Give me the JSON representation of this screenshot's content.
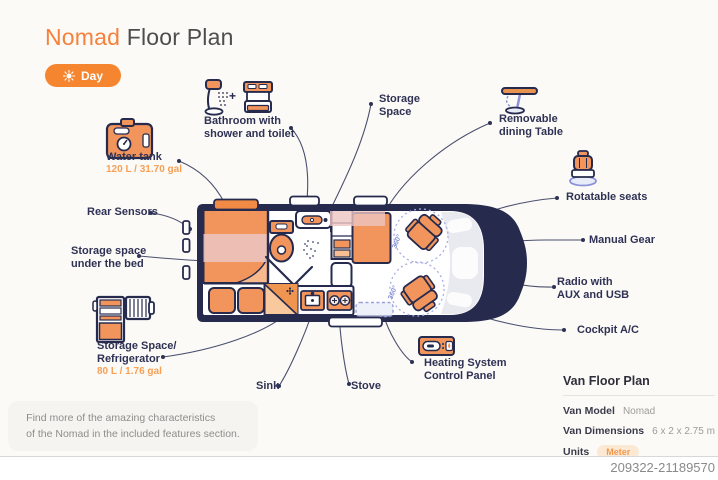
{
  "header": {
    "title_accent": "Nomad",
    "title_rest": " Floor Plan",
    "day_toggle": "Day"
  },
  "icons": {
    "bathroom_join": "+"
  },
  "labels": {
    "bathroom": "Bathroom with\nshower and toilet",
    "storage_space": "Storage\nSpace",
    "removable_table": "Removable\ndining Table",
    "water_tank": {
      "name": "Water tank",
      "value": "120 L / 31.70 gal"
    },
    "rear_sensors": "Rear Sensors",
    "storage_under_bed": "Storage space\nunder the bed",
    "refrigerator": {
      "name": "Storage Space/\nRefrigerator",
      "value": "80 L / 1.76 gal"
    },
    "sink": "Sink",
    "stove": "Stove",
    "heating": "Heating System\nControl Panel",
    "rotatable_seats": "Rotatable seats",
    "manual_gear": "Manual Gear",
    "radio": "Radio with\nAUX and USB",
    "cockpit_ac": "Cockpit A/C"
  },
  "floorplan": {
    "rotation_badge": "360°"
  },
  "info_panel": {
    "title": "Van Floor Plan",
    "rows": [
      {
        "label": "Van Model",
        "value": "Nomad"
      },
      {
        "label": "Van Dimensions",
        "value": "6 x 2 x 2.75 m"
      },
      {
        "label": "Units",
        "value": "Meter"
      }
    ]
  },
  "note": "Find more of the amazing characteristics\nof the Nomad in the included features section.",
  "footer": {
    "id": "209322-21189570"
  },
  "colors": {
    "accent": "#F5813A",
    "navy": "#262B4E",
    "furniture": "#F2955C",
    "pink_overlay": "#ECC5C2",
    "periwinkle": "#8A93D8",
    "value_orange": "#F7A055"
  }
}
